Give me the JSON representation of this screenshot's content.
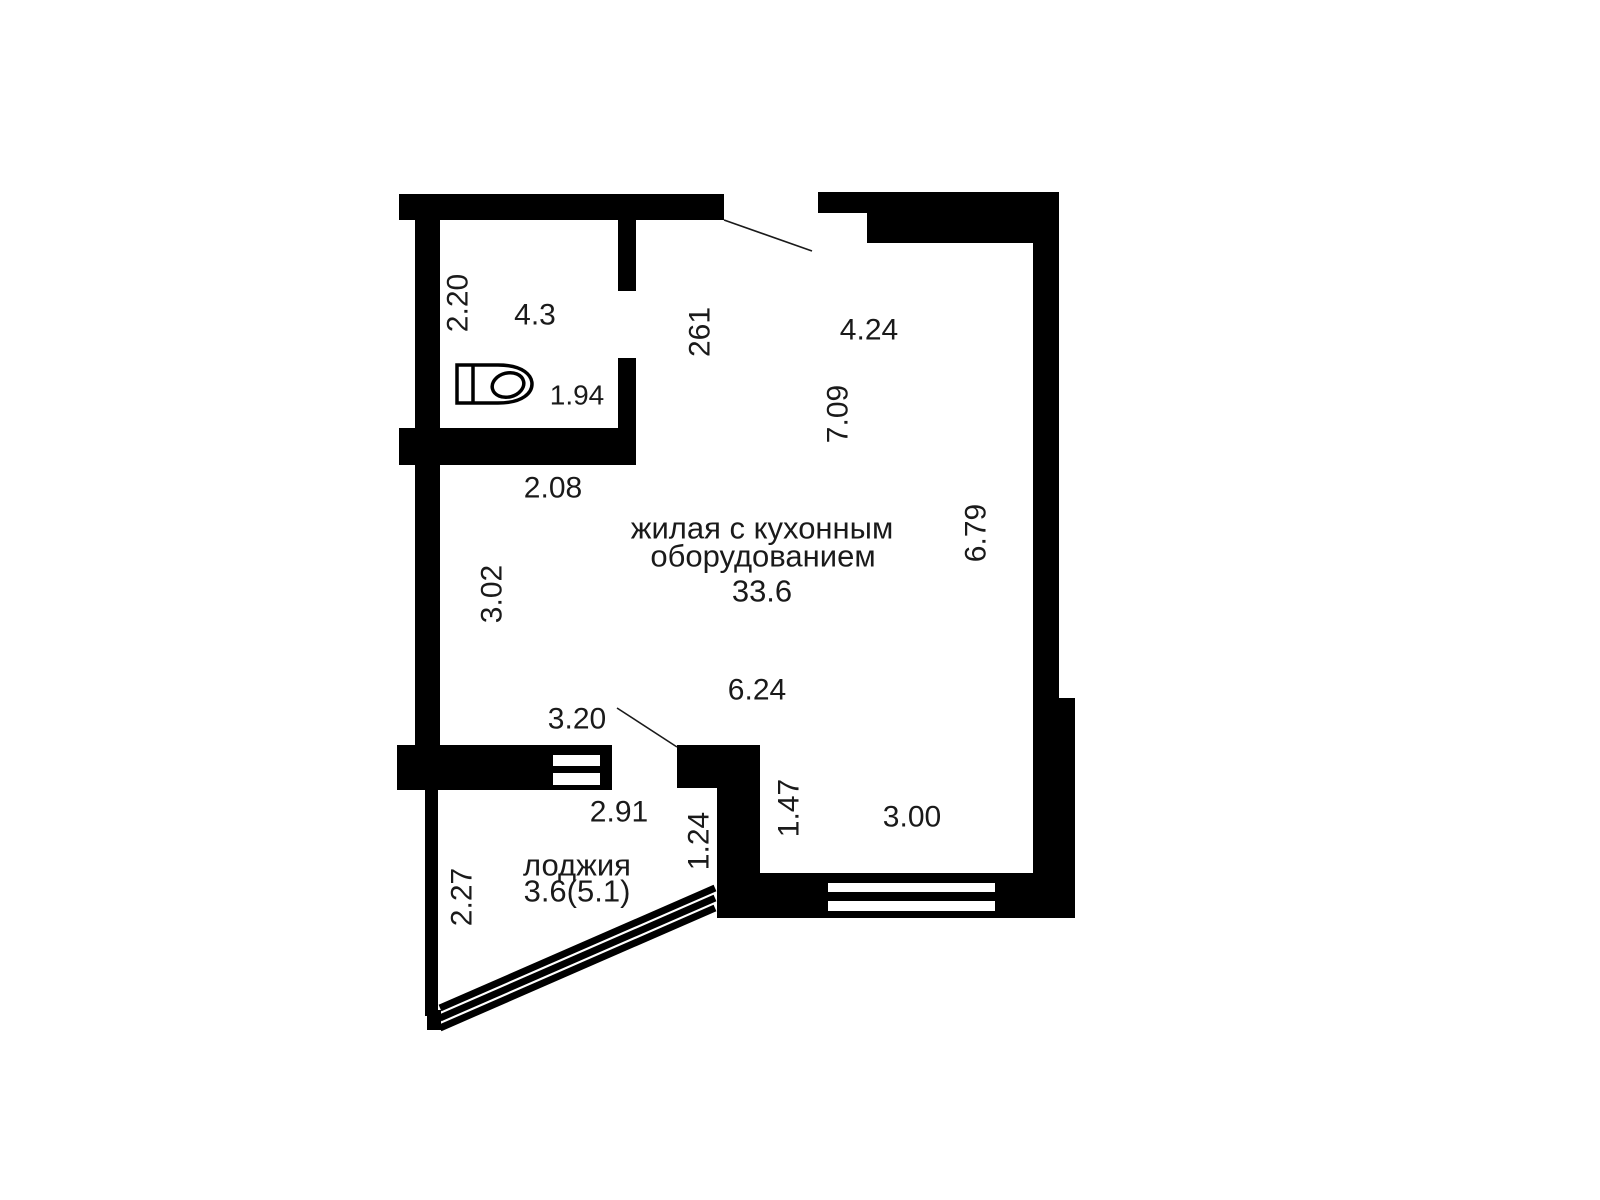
{
  "colors": {
    "wall": "#000000",
    "background": "#ffffff",
    "text": "#1a1a1a"
  },
  "rooms": {
    "living": {
      "name_line1": "жилая с кухонным",
      "name_line2": "оборудованием",
      "area": "33.6"
    },
    "loggia": {
      "name": "лоджия",
      "area": "3.6(5.1)"
    },
    "bathroom": {
      "area": "4.3"
    }
  },
  "dimensions": {
    "bathroom_depth": "2.20",
    "bathroom_width": "1.94",
    "entry_niche": "261",
    "top_width": "4.24",
    "right_upper_height": "7.09",
    "right_height": "6.79",
    "left_offset": "2.08",
    "left_height": "3.02",
    "living_bottom_width": "6.24",
    "loggia_door_width": "3.20",
    "loggia_width": "2.91",
    "loggia_depth": "2.27",
    "loggia_right_edge": "1.24",
    "corner_wall_height": "1.47",
    "window_width": "3.00"
  },
  "icons": {
    "toilet": "toilet-icon"
  }
}
